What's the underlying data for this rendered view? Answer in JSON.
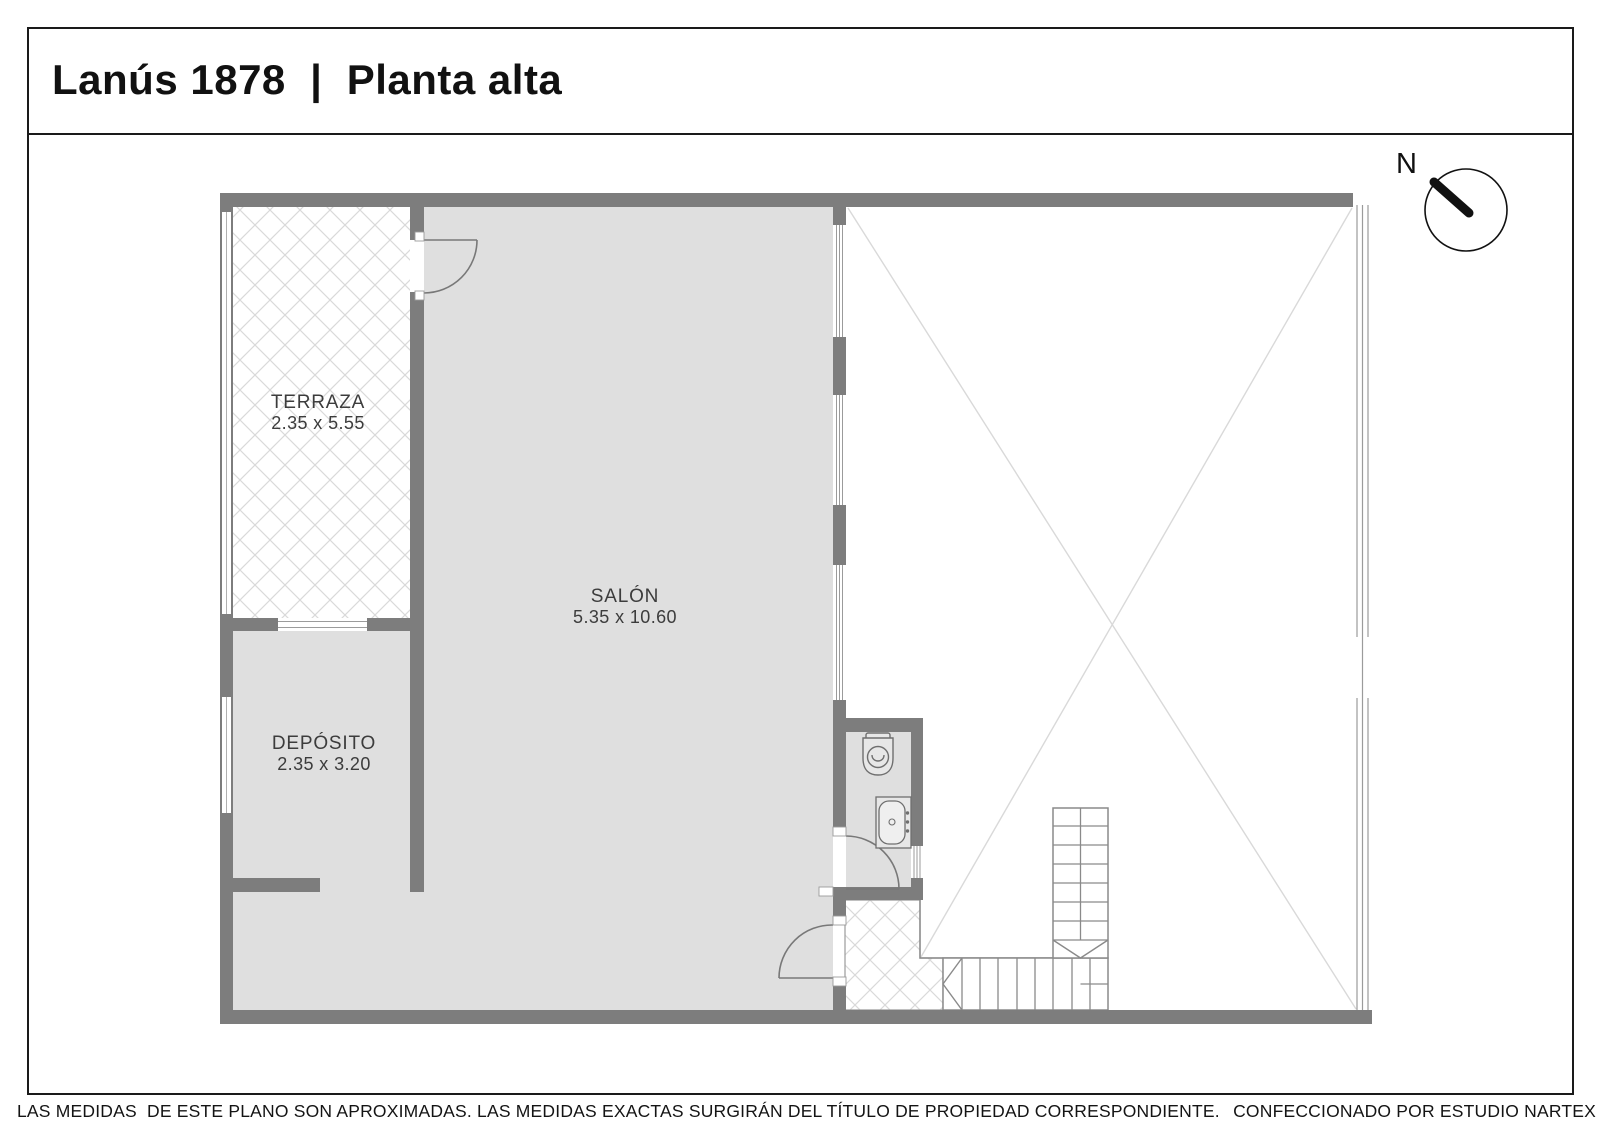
{
  "title": "Lanús 1878  |  Planta alta",
  "compass": {
    "north_label": "N"
  },
  "rooms": {
    "terraza": {
      "name": "TERRAZA",
      "dimensions": "2.35 x 5.55"
    },
    "salon": {
      "name": "SALÓN",
      "dimensions": "5.35 x 10.60"
    },
    "deposito": {
      "name": "DEPÓSITO",
      "dimensions": "2.35 x 3.20"
    }
  },
  "footer": {
    "disclaimer": "LAS MEDIDAS  DE ESTE PLANO SON APROXIMADAS. LAS MEDIDAS EXACTAS SURGIRÁN DEL TÍTULO DE PROPIEDAD CORRESPONDIENTE.",
    "credit": "CONFECCIONADO POR ESTUDIO NARTEX"
  },
  "colors": {
    "wall": "#7d7d7d",
    "floor": "#dfdfdf",
    "plan_line": "#8a8a8a",
    "window_line": "#9b9b9b",
    "hatch_line": "#d9d9d9",
    "void_cross_line": "#d9d9d9",
    "border": "#1a1a1a"
  }
}
